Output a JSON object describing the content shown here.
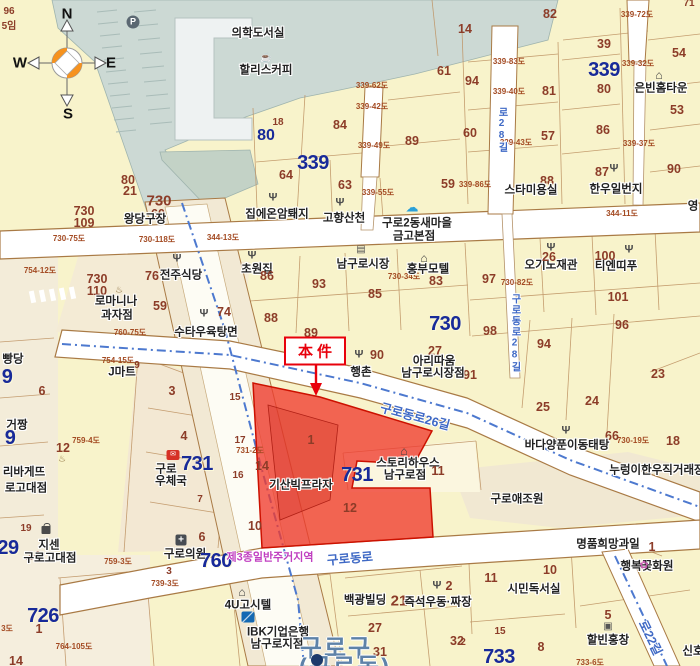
{
  "annotation": {
    "label": "本件"
  },
  "compass": {
    "n": "N",
    "w": "W",
    "e": "E",
    "s": "S"
  },
  "colors": {
    "background": "#f8f3cb",
    "water": "#ccd9d4",
    "subject_parcel_red": "#f03b2e",
    "annotation_red": "#e8000b",
    "block_number_blue": "#182a99",
    "parcel_number_brown": "#8c3c28",
    "road_name_blue": "#3f69c5",
    "boundary_dash_blue": "#4d79cf",
    "zoning_magenta": "#c03fc0",
    "district_blue": "#5e82a8"
  },
  "icon_glyphs": {
    "fork": "Ψ",
    "home": "⌂",
    "market": "▤",
    "coffee": "☕",
    "cloud": "☁",
    "bread": "♨",
    "basket": "▣",
    "flower": "✿",
    "post": "✉",
    "clinic": "+",
    "parking": "P",
    "ibk": "",
    "bag": "",
    "subway": ""
  },
  "icons": [
    {
      "k": "parking",
      "x": 133,
      "y": 22
    },
    {
      "k": "coffee",
      "x": 266,
      "y": 59
    },
    {
      "k": "fork",
      "x": 273,
      "y": 198
    },
    {
      "k": "fork",
      "x": 340,
      "y": 203
    },
    {
      "k": "fork",
      "x": 177,
      "y": 259
    },
    {
      "k": "fork",
      "x": 252,
      "y": 256
    },
    {
      "k": "fork",
      "x": 204,
      "y": 314
    },
    {
      "k": "fork",
      "x": 614,
      "y": 169
    },
    {
      "k": "fork",
      "x": 551,
      "y": 248
    },
    {
      "k": "fork",
      "x": 629,
      "y": 250
    },
    {
      "k": "fork",
      "x": 359,
      "y": 355
    },
    {
      "k": "fork",
      "x": 566,
      "y": 431
    },
    {
      "k": "fork",
      "x": 437,
      "y": 586
    },
    {
      "k": "home",
      "x": 659,
      "y": 75
    },
    {
      "k": "home",
      "x": 424,
      "y": 258
    },
    {
      "k": "home",
      "x": 404,
      "y": 451
    },
    {
      "k": "home",
      "x": 242,
      "y": 592
    },
    {
      "k": "market",
      "x": 361,
      "y": 250
    },
    {
      "k": "cloud",
      "x": 412,
      "y": 207
    },
    {
      "k": "post",
      "x": 173,
      "y": 455
    },
    {
      "k": "clinic",
      "x": 181,
      "y": 540
    },
    {
      "k": "ibk",
      "x": 248,
      "y": 617
    },
    {
      "k": "bag",
      "x": 46,
      "y": 530
    },
    {
      "k": "bread",
      "x": 119,
      "y": 290
    },
    {
      "k": "bread",
      "x": 62,
      "y": 459
    },
    {
      "k": "basket",
      "x": 608,
      "y": 627
    },
    {
      "k": "flower",
      "x": 644,
      "y": 566
    },
    {
      "k": "subway",
      "x": 317,
      "y": 660
    }
  ],
  "labels": [
    {
      "t": "96",
      "x": 9,
      "y": 12,
      "c": "nsm"
    },
    {
      "t": "5임",
      "x": 9,
      "y": 27,
      "c": "nsm"
    },
    {
      "t": "N",
      "x": 67,
      "y": 14,
      "c": "comp"
    },
    {
      "t": "W",
      "x": 20,
      "y": 63,
      "c": "comp"
    },
    {
      "t": "E",
      "x": 111,
      "y": 63,
      "c": "comp"
    },
    {
      "t": "S",
      "x": 68,
      "y": 114,
      "c": "comp"
    },
    {
      "t": "의학도서실",
      "x": 258,
      "y": 34,
      "c": "poi"
    },
    {
      "t": "할리스커피",
      "x": 266,
      "y": 71,
      "c": "poi"
    },
    {
      "t": "14",
      "x": 465,
      "y": 29,
      "c": "n"
    },
    {
      "t": "82",
      "x": 550,
      "y": 14,
      "c": "n"
    },
    {
      "t": "71",
      "x": 689,
      "y": 4,
      "c": "nsm"
    },
    {
      "t": "39",
      "x": 604,
      "y": 44,
      "c": "n"
    },
    {
      "t": "61",
      "x": 444,
      "y": 71,
      "c": "n"
    },
    {
      "t": "339",
      "x": 604,
      "y": 70,
      "c": "nb",
      "nm": "block-number-339"
    },
    {
      "t": "80",
      "x": 604,
      "y": 89,
      "c": "n"
    },
    {
      "t": "94",
      "x": 472,
      "y": 81,
      "c": "n"
    },
    {
      "t": "54",
      "x": 679,
      "y": 53,
      "c": "n"
    },
    {
      "t": "은빈홈타운",
      "x": 661,
      "y": 89,
      "c": "poi"
    },
    {
      "t": "81",
      "x": 549,
      "y": 91,
      "c": "n"
    },
    {
      "t": "53",
      "x": 677,
      "y": 110,
      "c": "n"
    },
    {
      "t": "60",
      "x": 470,
      "y": 133,
      "c": "n"
    },
    {
      "t": "57",
      "x": 548,
      "y": 136,
      "c": "n"
    },
    {
      "t": "86",
      "x": 603,
      "y": 130,
      "c": "n"
    },
    {
      "t": "84",
      "x": 340,
      "y": 125,
      "c": "n"
    },
    {
      "t": "89",
      "x": 412,
      "y": 141,
      "c": "n"
    },
    {
      "t": "18",
      "x": 278,
      "y": 123,
      "c": "nsm"
    },
    {
      "t": "80",
      "x": 266,
      "y": 136,
      "c": "nbm"
    },
    {
      "t": "339",
      "x": 313,
      "y": 163,
      "c": "nb",
      "nm": "block-number-339"
    },
    {
      "t": "64",
      "x": 286,
      "y": 175,
      "c": "n"
    },
    {
      "t": "63",
      "x": 345,
      "y": 185,
      "c": "n"
    },
    {
      "t": "59",
      "x": 448,
      "y": 184,
      "c": "n"
    },
    {
      "t": "88",
      "x": 547,
      "y": 181,
      "c": "n"
    },
    {
      "t": "87",
      "x": 602,
      "y": 172,
      "c": "n"
    },
    {
      "t": "90",
      "x": 674,
      "y": 169,
      "c": "n"
    },
    {
      "t": "스타미용실",
      "x": 531,
      "y": 191,
      "c": "poi"
    },
    {
      "t": "한우일번지",
      "x": 616,
      "y": 190,
      "c": "poi"
    },
    {
      "t": "영",
      "x": 693,
      "y": 207,
      "c": "poi"
    },
    {
      "t": "339-72도",
      "x": 637,
      "y": 15,
      "c": "rd"
    },
    {
      "t": "339-83도",
      "x": 509,
      "y": 62,
      "c": "rd"
    },
    {
      "t": "339-32도",
      "x": 638,
      "y": 64,
      "c": "rd"
    },
    {
      "t": "339-62도",
      "x": 372,
      "y": 86,
      "c": "rd"
    },
    {
      "t": "339-40도",
      "x": 509,
      "y": 92,
      "c": "rd"
    },
    {
      "t": "339-42도",
      "x": 372,
      "y": 107,
      "c": "rd"
    },
    {
      "t": "339-49도",
      "x": 374,
      "y": 146,
      "c": "rd"
    },
    {
      "t": "339-43도",
      "x": 516,
      "y": 143,
      "c": "rd"
    },
    {
      "t": "339-37도",
      "x": 639,
      "y": 144,
      "c": "rd"
    },
    {
      "t": "339-55도",
      "x": 378,
      "y": 193,
      "c": "rd"
    },
    {
      "t": "339-86도",
      "x": 475,
      "y": 185,
      "c": "rd"
    },
    {
      "t": "344-11도",
      "x": 622,
      "y": 214,
      "c": "rd"
    },
    {
      "t": "344-13도",
      "x": 223,
      "y": 238,
      "c": "rd"
    },
    {
      "t": "730-118도",
      "x": 157,
      "y": 240,
      "c": "rd"
    },
    {
      "t": "730-75도",
      "x": 69,
      "y": 239,
      "c": "rd"
    },
    {
      "t": "754-12도",
      "x": 40,
      "y": 271,
      "c": "rd"
    },
    {
      "t": "730-34도",
      "x": 404,
      "y": 277,
      "c": "rd"
    },
    {
      "t": "730-82도",
      "x": 517,
      "y": 283,
      "c": "rd"
    },
    {
      "t": "754-15도",
      "x": 118,
      "y": 361,
      "c": "rd"
    },
    {
      "t": "759-4도",
      "x": 86,
      "y": 441,
      "c": "rd"
    },
    {
      "t": "731-2도",
      "x": 250,
      "y": 451,
      "c": "rd"
    },
    {
      "t": "760-75도",
      "x": 130,
      "y": 333,
      "c": "rd"
    },
    {
      "t": "759-3도",
      "x": 118,
      "y": 562,
      "c": "rd"
    },
    {
      "t": "739-3도",
      "x": 165,
      "y": 584,
      "c": "rd"
    },
    {
      "t": "764-105도",
      "x": 74,
      "y": 647,
      "c": "rd"
    },
    {
      "t": "730-19도",
      "x": 633,
      "y": 441,
      "c": "rd"
    },
    {
      "t": "733-6도",
      "x": 590,
      "y": 663,
      "c": "rd"
    },
    {
      "t": "3도",
      "x": 7,
      "y": 629,
      "c": "rd"
    },
    {
      "t": "80",
      "x": 128,
      "y": 180,
      "c": "n"
    },
    {
      "t": "21",
      "x": 130,
      "y": 191,
      "c": "n"
    },
    {
      "t": "730",
      "x": 159,
      "y": 201,
      "c": "nmd"
    },
    {
      "t": "60",
      "x": 158,
      "y": 214,
      "c": "n"
    },
    {
      "t": "730",
      "x": 84,
      "y": 211,
      "c": "n"
    },
    {
      "t": "109",
      "x": 84,
      "y": 223,
      "c": "n"
    },
    {
      "t": "왕당구장",
      "x": 145,
      "y": 220,
      "c": "poi"
    },
    {
      "t": "730",
      "x": 97,
      "y": 279,
      "c": "n"
    },
    {
      "t": "110",
      "x": 97,
      "y": 291,
      "c": "n"
    },
    {
      "t": "집에온암퇘지",
      "x": 277,
      "y": 215,
      "c": "poi"
    },
    {
      "t": "고향산천",
      "x": 344,
      "y": 219,
      "c": "poi"
    },
    {
      "t": "구로2동새마을",
      "x": 417,
      "y": 224,
      "c": "poi"
    },
    {
      "t": "금고본점",
      "x": 414,
      "y": 237,
      "c": "poi"
    },
    {
      "t": "전주식당",
      "x": 181,
      "y": 276,
      "c": "poi"
    },
    {
      "t": "76",
      "x": 152,
      "y": 276,
      "c": "n"
    },
    {
      "t": "초원집",
      "x": 257,
      "y": 270,
      "c": "poi"
    },
    {
      "t": "86",
      "x": 267,
      "y": 276,
      "c": "n"
    },
    {
      "t": "남구로시장",
      "x": 363,
      "y": 265,
      "c": "poi"
    },
    {
      "t": "홍부모텔",
      "x": 428,
      "y": 270,
      "c": "poi"
    },
    {
      "t": "83",
      "x": 436,
      "y": 281,
      "c": "n"
    },
    {
      "t": "93",
      "x": 319,
      "y": 284,
      "c": "n"
    },
    {
      "t": "85",
      "x": 375,
      "y": 294,
      "c": "n"
    },
    {
      "t": "97",
      "x": 489,
      "y": 279,
      "c": "n"
    },
    {
      "t": "오기노재관",
      "x": 551,
      "y": 266,
      "c": "poi"
    },
    {
      "t": "26",
      "x": 549,
      "y": 257,
      "c": "n"
    },
    {
      "t": "티엔띠푸",
      "x": 616,
      "y": 267,
      "c": "poi"
    },
    {
      "t": "100",
      "x": 605,
      "y": 256,
      "c": "n"
    },
    {
      "t": "101",
      "x": 618,
      "y": 297,
      "c": "n"
    },
    {
      "t": "96",
      "x": 622,
      "y": 325,
      "c": "n"
    },
    {
      "t": "98",
      "x": 490,
      "y": 331,
      "c": "n"
    },
    {
      "t": "로마니나",
      "x": 116,
      "y": 302,
      "c": "poi"
    },
    {
      "t": "과자점",
      "x": 117,
      "y": 316,
      "c": "poi"
    },
    {
      "t": "59",
      "x": 160,
      "y": 306,
      "c": "n"
    },
    {
      "t": "수타우육탕면",
      "x": 206,
      "y": 333,
      "c": "poi"
    },
    {
      "t": "74",
      "x": 224,
      "y": 312,
      "c": "n"
    },
    {
      "t": "88",
      "x": 271,
      "y": 318,
      "c": "n"
    },
    {
      "t": "89",
      "x": 311,
      "y": 333,
      "c": "n"
    },
    {
      "t": "730",
      "x": 445,
      "y": 324,
      "c": "nb",
      "nm": "block-number-730"
    },
    {
      "t": "91",
      "x": 470,
      "y": 375,
      "c": "n"
    },
    {
      "t": "27",
      "x": 435,
      "y": 351,
      "c": "n"
    },
    {
      "t": "아리따움",
      "x": 434,
      "y": 362,
      "c": "poi"
    },
    {
      "t": "남구로시장점",
      "x": 433,
      "y": 374,
      "c": "poi"
    },
    {
      "t": "90",
      "x": 377,
      "y": 355,
      "c": "n"
    },
    {
      "t": "행촌",
      "x": 361,
      "y": 373,
      "c": "poi"
    },
    {
      "t": "구로동로26길",
      "x": 415,
      "y": 417,
      "c": "road",
      "r": 15,
      "nm": "road-name-gurodongro26gil"
    },
    {
      "t": "구로동로28길",
      "x": 514,
      "y": 333,
      "c": "roadv",
      "v": 1,
      "nm": "road-name-gurodongro28gil"
    },
    {
      "t": "로28길",
      "x": 501,
      "y": 130,
      "c": "roadv",
      "v": 1
    },
    {
      "t": "94",
      "x": 544,
      "y": 344,
      "c": "n"
    },
    {
      "t": "23",
      "x": 658,
      "y": 374,
      "c": "n"
    },
    {
      "t": "25",
      "x": 543,
      "y": 407,
      "c": "n"
    },
    {
      "t": "24",
      "x": 592,
      "y": 401,
      "c": "n"
    },
    {
      "t": "66",
      "x": 612,
      "y": 436,
      "c": "n"
    },
    {
      "t": "18",
      "x": 673,
      "y": 441,
      "c": "n"
    },
    {
      "t": "바다양푼이동태탕",
      "x": 567,
      "y": 446,
      "c": "poi"
    },
    {
      "t": "누렁이한우직거래장",
      "x": 657,
      "y": 471,
      "c": "poi"
    },
    {
      "t": "J마트",
      "x": 122,
      "y": 373,
      "c": "poi"
    },
    {
      "t": "9",
      "x": 137,
      "y": 366,
      "c": "nsm"
    },
    {
      "t": "3",
      "x": 172,
      "y": 391,
      "c": "n"
    },
    {
      "t": "4",
      "x": 184,
      "y": 436,
      "c": "n"
    },
    {
      "t": "15",
      "x": 235,
      "y": 398,
      "c": "nsm"
    },
    {
      "t": "17",
      "x": 240,
      "y": 441,
      "c": "nsm"
    },
    {
      "t": "14",
      "x": 262,
      "y": 466,
      "c": "n"
    },
    {
      "t": "16",
      "x": 238,
      "y": 476,
      "c": "nsm"
    },
    {
      "t": "10",
      "x": 255,
      "y": 526,
      "c": "n"
    },
    {
      "t": "1",
      "x": 311,
      "y": 440,
      "c": "n",
      "nm": "subject-parcel-number-1"
    },
    {
      "t": "기산빅프라자",
      "x": 301,
      "y": 486,
      "c": "poi",
      "nm": "poi-kisan-big-plaza"
    },
    {
      "t": "12",
      "x": 350,
      "y": 508,
      "c": "n",
      "nm": "subject-parcel-number-12"
    },
    {
      "t": "731",
      "x": 197,
      "y": 464,
      "c": "nb",
      "nm": "block-number-731"
    },
    {
      "t": "731",
      "x": 357,
      "y": 475,
      "c": "nb",
      "nm": "block-number-731"
    },
    {
      "t": "스토리하우스",
      "x": 408,
      "y": 464,
      "c": "poi"
    },
    {
      "t": "남구로점",
      "x": 405,
      "y": 476,
      "c": "poi"
    },
    {
      "t": "11",
      "x": 438,
      "y": 471,
      "c": "n"
    },
    {
      "t": "구로",
      "x": 166,
      "y": 470,
      "c": "poi"
    },
    {
      "t": "우체국",
      "x": 171,
      "y": 482,
      "c": "poi"
    },
    {
      "t": "7",
      "x": 200,
      "y": 500,
      "c": "nsm"
    },
    {
      "t": "구로애조원",
      "x": 517,
      "y": 500,
      "c": "poi"
    },
    {
      "t": "구로의원",
      "x": 185,
      "y": 555,
      "c": "poi"
    },
    {
      "t": "6",
      "x": 202,
      "y": 537,
      "c": "n"
    },
    {
      "t": "3",
      "x": 169,
      "y": 572,
      "c": "nsm"
    },
    {
      "t": "760",
      "x": 216,
      "y": 561,
      "c": "nb",
      "nm": "block-number-760"
    },
    {
      "t": "제3종일반주거지역",
      "x": 270,
      "y": 558,
      "c": "zone",
      "nm": "zoning-label"
    },
    {
      "t": "구로동로",
      "x": 350,
      "y": 559,
      "c": "road",
      "r": -5,
      "nm": "road-name-gurodongro"
    },
    {
      "t": "4U고시텔",
      "x": 248,
      "y": 606,
      "c": "poi"
    },
    {
      "t": "IBK기업은행",
      "x": 278,
      "y": 633,
      "c": "poi"
    },
    {
      "t": "남구로지점",
      "x": 277,
      "y": 645,
      "c": "poi"
    },
    {
      "t": "백광빌딩",
      "x": 365,
      "y": 601,
      "c": "poi"
    },
    {
      "t": "21",
      "x": 399,
      "y": 601,
      "c": "nmd"
    },
    {
      "t": "즉석우동·짜장",
      "x": 438,
      "y": 603,
      "c": "poi"
    },
    {
      "t": "2",
      "x": 449,
      "y": 586,
      "c": "n"
    },
    {
      "t": "27",
      "x": 375,
      "y": 628,
      "c": "n"
    },
    {
      "t": "31",
      "x": 380,
      "y": 652,
      "c": "n"
    },
    {
      "t": "32",
      "x": 457,
      "y": 641,
      "c": "n"
    },
    {
      "t": "구로구",
      "x": 336,
      "y": 649,
      "c": "city",
      "nm": "district-label-guro-gu"
    },
    {
      "t": "(구로동)",
      "x": 345,
      "y": 668,
      "c": "city",
      "nm": "district-label-guro-dong"
    },
    {
      "t": "시민독서실",
      "x": 534,
      "y": 590,
      "c": "poi"
    },
    {
      "t": "10",
      "x": 550,
      "y": 570,
      "c": "n"
    },
    {
      "t": "11",
      "x": 491,
      "y": 578,
      "c": "n"
    },
    {
      "t": "명품희망과일",
      "x": 608,
      "y": 545,
      "c": "poi"
    },
    {
      "t": "1",
      "x": 652,
      "y": 547,
      "c": "n"
    },
    {
      "t": "행복꽃화원",
      "x": 647,
      "y": 567,
      "c": "poi"
    },
    {
      "t": "5",
      "x": 608,
      "y": 615,
      "c": "n"
    },
    {
      "t": "할빈홍창",
      "x": 608,
      "y": 641,
      "c": "poi"
    },
    {
      "t": "15",
      "x": 500,
      "y": 632,
      "c": "nsm"
    },
    {
      "t": "8",
      "x": 541,
      "y": 647,
      "c": "n"
    },
    {
      "t": "2",
      "x": 463,
      "y": 643,
      "c": "nsm"
    },
    {
      "t": "733",
      "x": 499,
      "y": 657,
      "c": "nb",
      "nm": "block-number-733"
    },
    {
      "t": "신호",
      "x": 693,
      "y": 652,
      "c": "poi"
    },
    {
      "t": "로22길",
      "x": 650,
      "y": 638,
      "c": "road",
      "r": 64
    },
    {
      "t": "빵당",
      "x": 13,
      "y": 360,
      "c": "poi"
    },
    {
      "t": "9",
      "x": 7,
      "y": 377,
      "c": "nb"
    },
    {
      "t": "6",
      "x": 42,
      "y": 391,
      "c": "n"
    },
    {
      "t": "거짱",
      "x": 17,
      "y": 426,
      "c": "poi"
    },
    {
      "t": "9",
      "x": 10,
      "y": 438,
      "c": "nb"
    },
    {
      "t": "12",
      "x": 63,
      "y": 448,
      "c": "n"
    },
    {
      "t": "리바게뜨",
      "x": 24,
      "y": 473,
      "c": "poi"
    },
    {
      "t": "로고대점",
      "x": 26,
      "y": 489,
      "c": "poi"
    },
    {
      "t": "19",
      "x": 26,
      "y": 529,
      "c": "nsm"
    },
    {
      "t": "지센",
      "x": 49,
      "y": 546,
      "c": "poi"
    },
    {
      "t": "24",
      "x": 33,
      "y": 556,
      "c": "n"
    },
    {
      "t": "구로고대점",
      "x": 50,
      "y": 559,
      "c": "poi"
    },
    {
      "t": "29",
      "x": 8,
      "y": 548,
      "c": "nb"
    },
    {
      "t": "726",
      "x": 43,
      "y": 616,
      "c": "nb",
      "nm": "block-number-726"
    },
    {
      "t": "1",
      "x": 39,
      "y": 629,
      "c": "n"
    },
    {
      "t": "14",
      "x": 16,
      "y": 661,
      "c": "n"
    }
  ]
}
